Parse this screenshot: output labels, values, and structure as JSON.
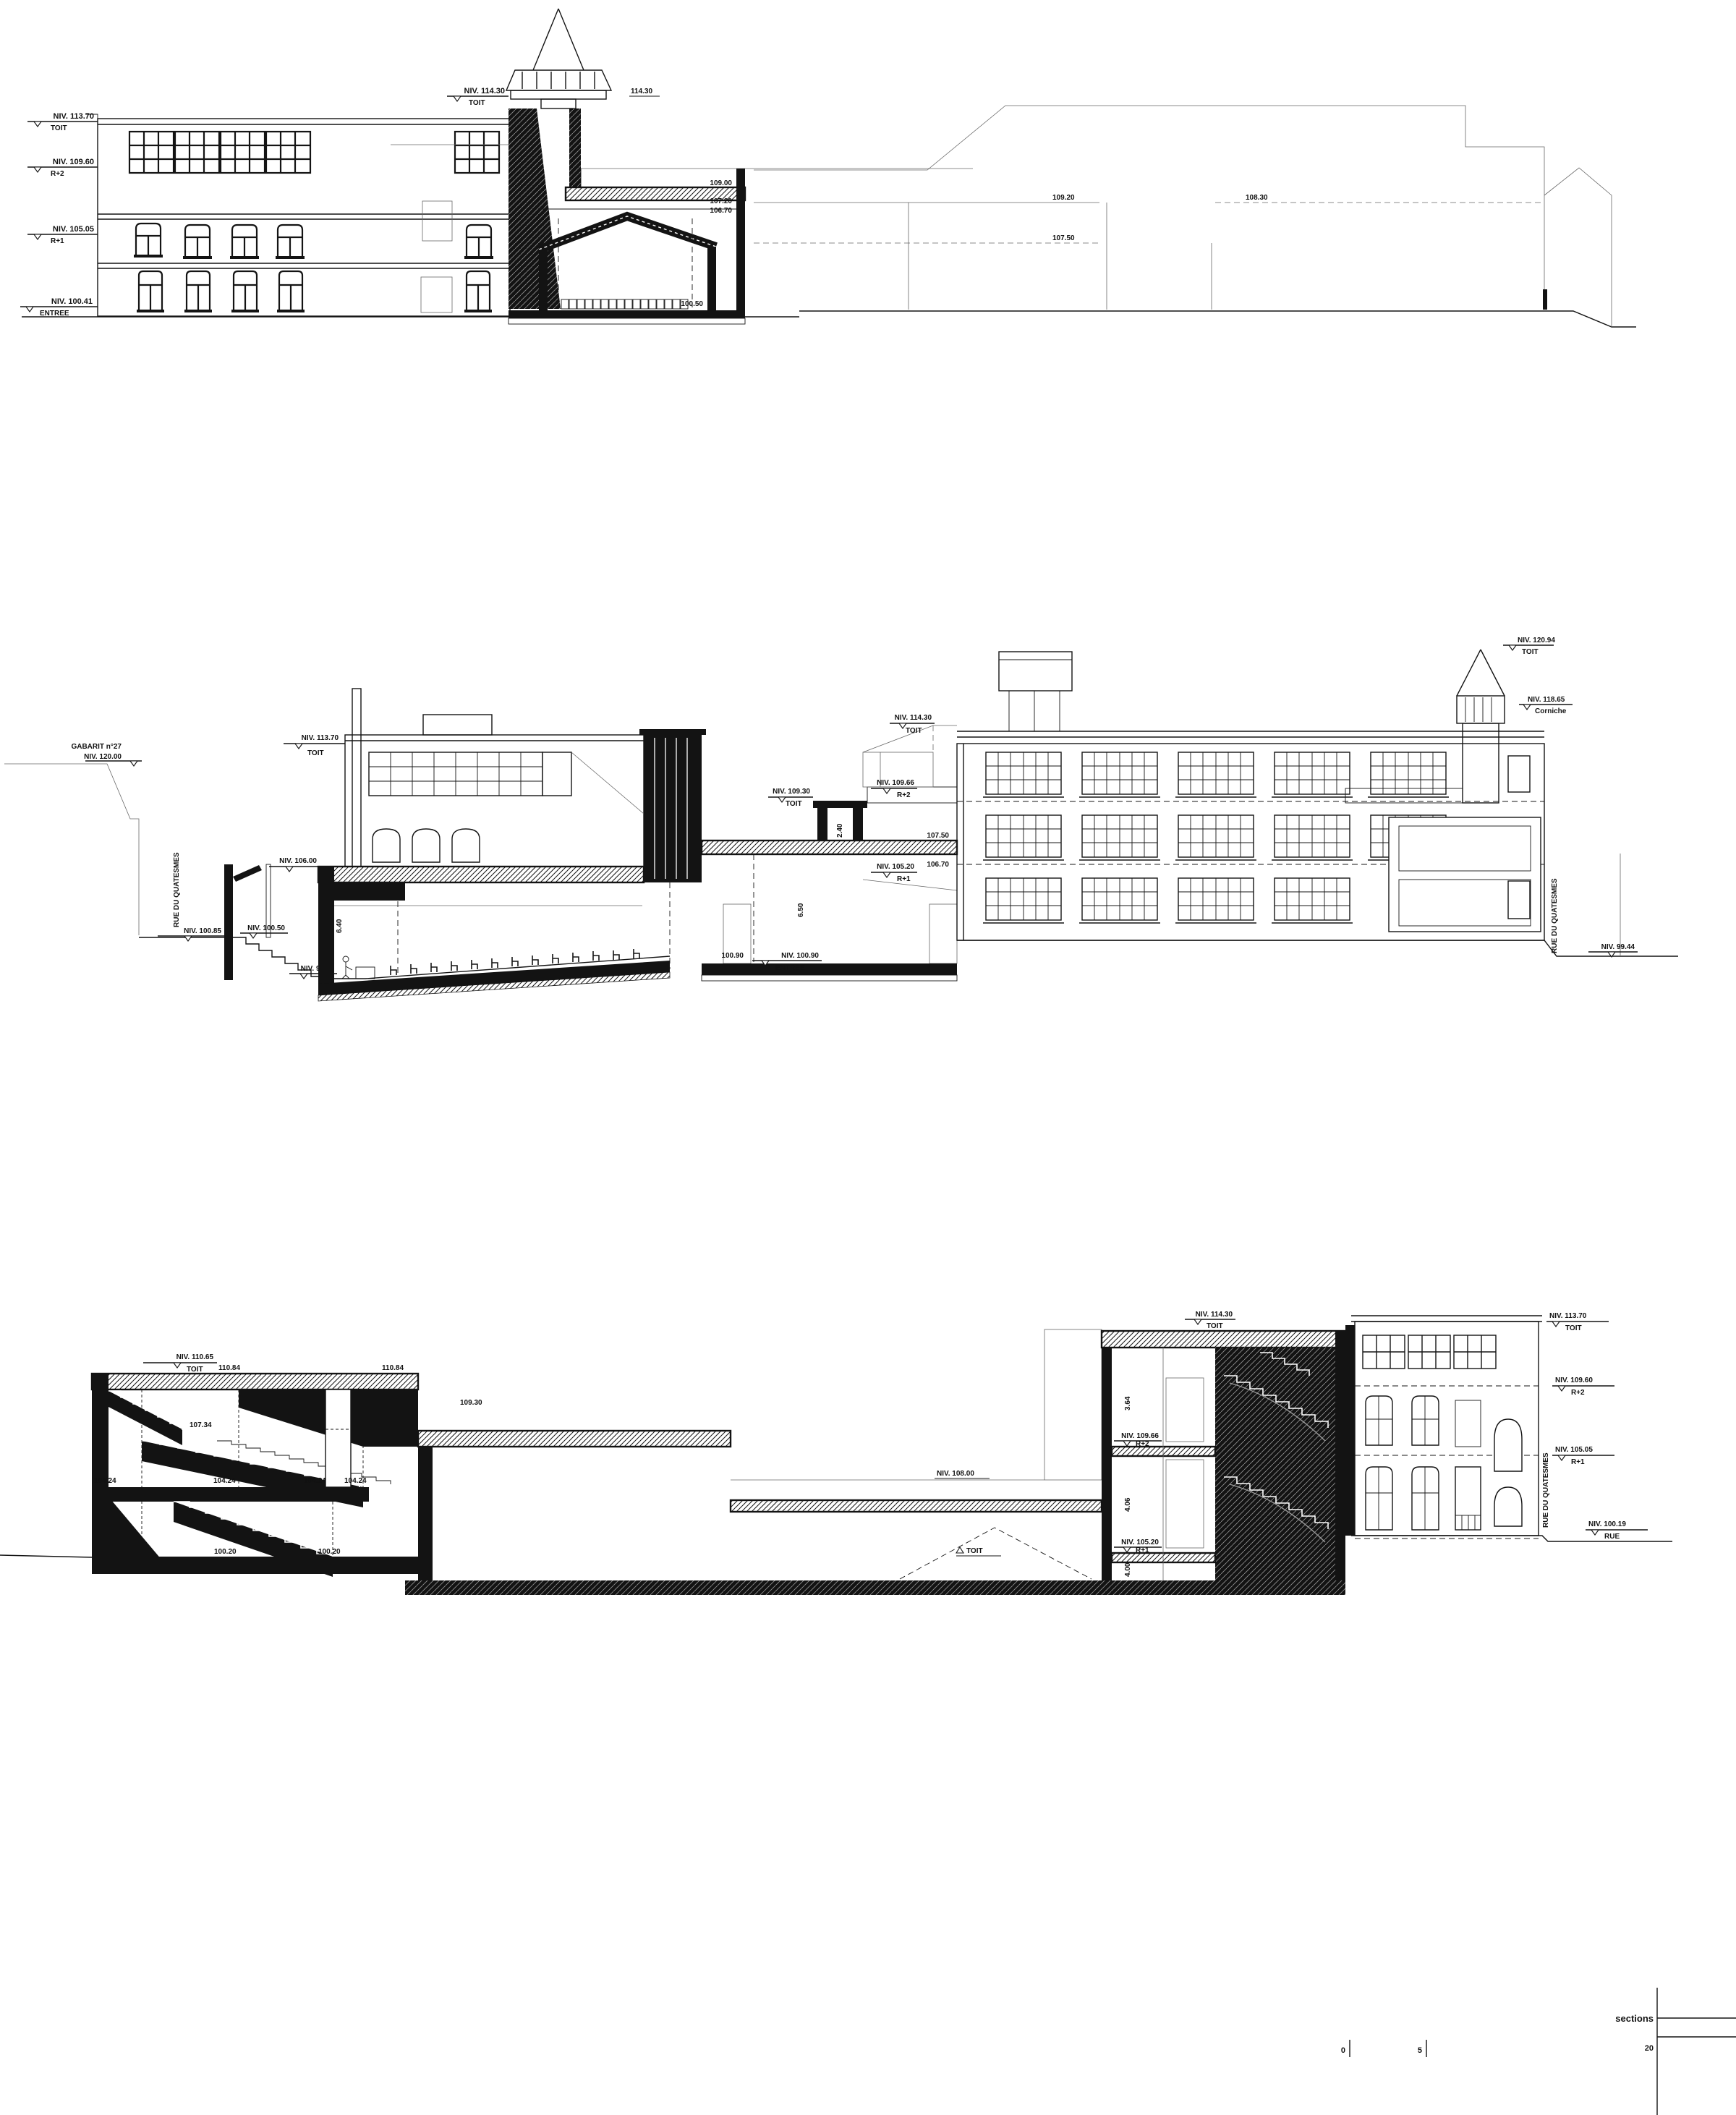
{
  "sheet": {
    "background": "#ffffff",
    "ink": "#141414",
    "title": "sections",
    "scale": {
      "zero": "0",
      "five": "5",
      "twenty": "20"
    }
  },
  "s1": {
    "levels": [
      {
        "niv": "NIV. 113.70",
        "name": "TOIT"
      },
      {
        "niv": "NIV. 109.60",
        "name": "R+2"
      },
      {
        "niv": "NIV. 105.05",
        "name": "R+1"
      },
      {
        "niv": "NIV. 100.41",
        "name": "ENTREE"
      }
    ],
    "tower": {
      "niv": "NIV. 114.30",
      "name": "TOIT",
      "spot": "114.30"
    },
    "hall": {
      "a": "109.00",
      "b": "107.20",
      "c": "106.70",
      "d": "100.50"
    },
    "bg": {
      "a": "109.20",
      "b": "107.50",
      "c": "108.30"
    }
  },
  "s2": {
    "gabarit": {
      "line1": "GABARIT n°27",
      "line2": "NIV. 120.00"
    },
    "street_left": {
      "name": "RUE DU QUATESMES",
      "niv": "NIV. 100.85"
    },
    "entry": {
      "a": "NIV. 100.50",
      "b": "NIV. 99.40"
    },
    "school": {
      "toit": "NIV. 113.70",
      "toit_name": "TOIT",
      "roof": "NIV. 106.00"
    },
    "aud": {
      "dim": "6.40"
    },
    "foyer": {
      "a": "107.50",
      "b": "106.70",
      "dim": "6.50",
      "floor": "100.90",
      "niv": "NIV. 100.90",
      "niv_name": "ENTREE"
    },
    "towerette": {
      "niv": "NIV. 109.30",
      "name": "TOIT",
      "dim": "2.40"
    },
    "balcony": {
      "niv": "NIV. 109.66",
      "name": "R+2"
    },
    "r1": {
      "niv": "NIV. 105.20",
      "name": "R+1"
    },
    "apex": {
      "niv": "NIV. 114.30",
      "name": "TOIT"
    },
    "factory": {
      "spire": "NIV. 120.94",
      "spire_name": "TOIT",
      "corniche": "NIV. 118.65",
      "corniche_name": "Corniche"
    },
    "street_right": {
      "name": "RUE DU QUATESMES",
      "niv": "NIV. 99.44"
    }
  },
  "s3": {
    "roof": {
      "niv": "NIV. 110.65",
      "name": "TOIT"
    },
    "spots": {
      "a": "110.84",
      "b": "110.84",
      "c": "109.30",
      "d": "107.34",
      "e": "104.24",
      "f": "104.24",
      "g": "104.24",
      "h": "104.24",
      "i": "100.20",
      "j": "100.20"
    },
    "hall": {
      "niv": "NIV. 108.00",
      "toit": "TOIT"
    },
    "tower": {
      "toit": "NIV. 114.30",
      "toit_name": "TOIT",
      "r2": "NIV. 109.66",
      "r2_name": "R+2",
      "r1": "NIV. 105.20",
      "r1_name": "R+1",
      "d1": "3.64",
      "d2": "4.06",
      "d3": "4.00"
    },
    "facade": {
      "toit": "NIV. 113.70",
      "toit_name": "TOIT",
      "r2": "NIV. 109.60",
      "r2_name": "R+2",
      "r1": "NIV. 105.05",
      "r1_name": "R+1",
      "rue": "NIV. 100.19",
      "rue_name": "RUE",
      "street": "RUE DU QUATESMES"
    }
  }
}
